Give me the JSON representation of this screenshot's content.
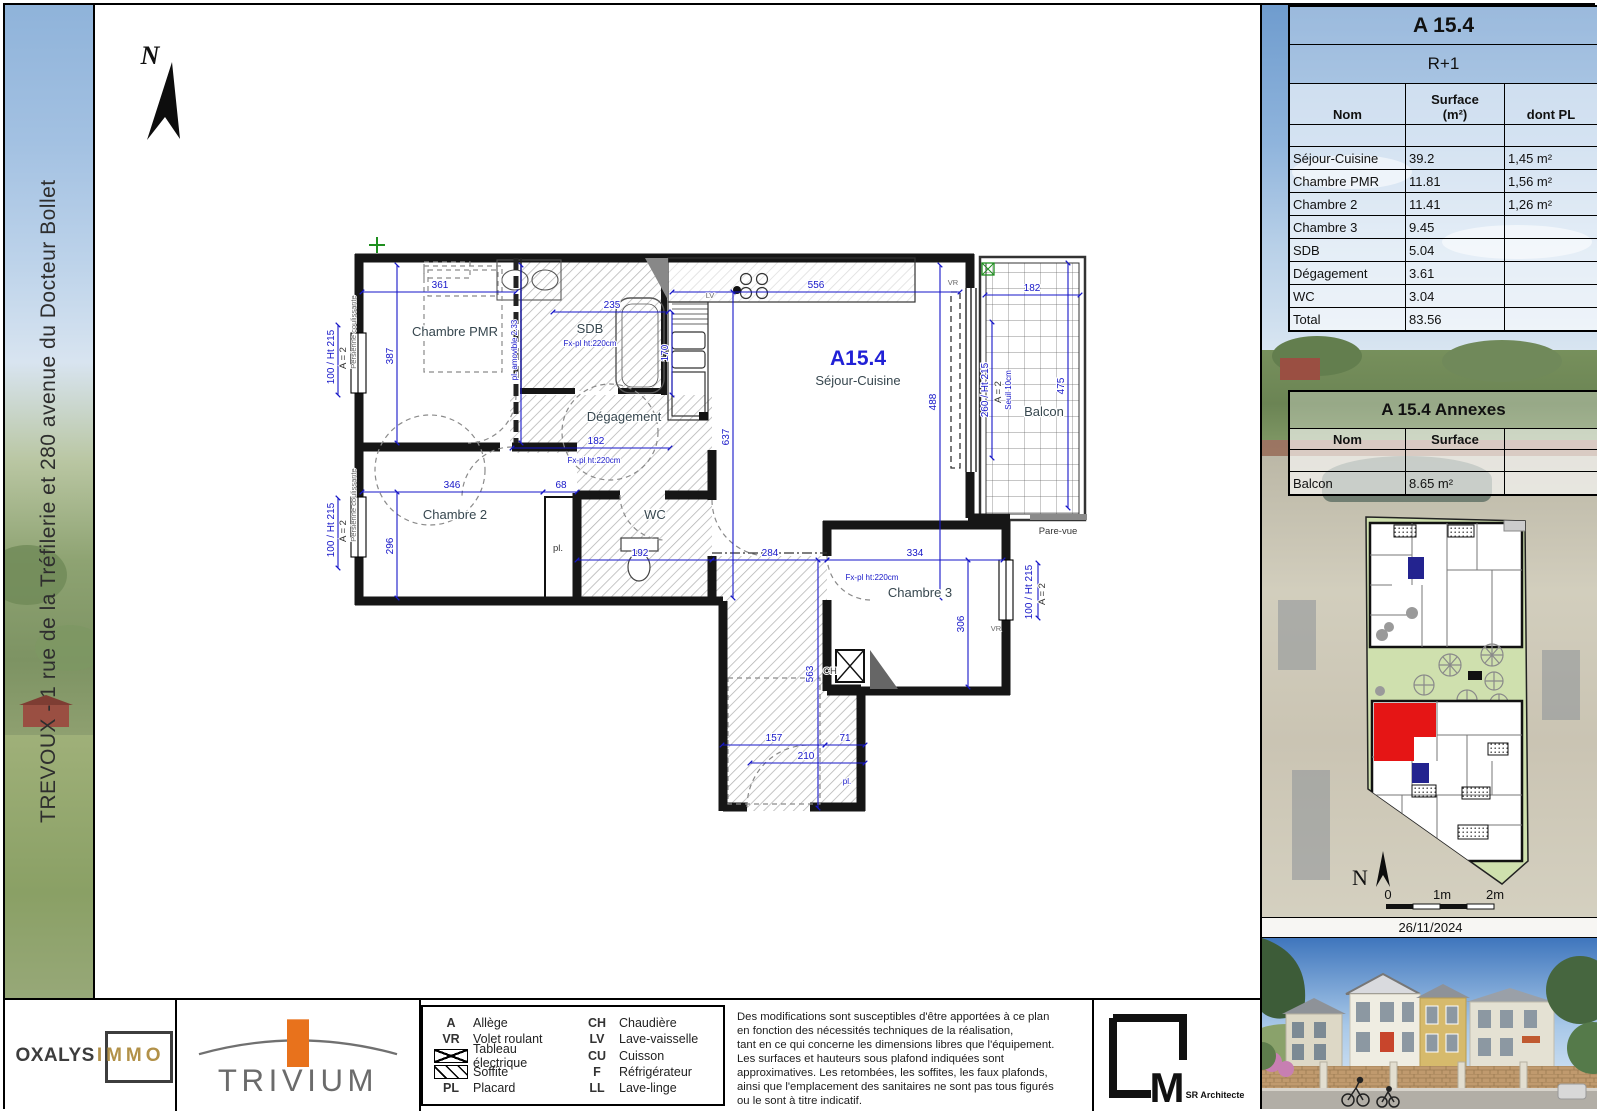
{
  "sidebar": {
    "title": "TREVOUX - 1 rue de la Tréfilerie et 280 avenue du Docteur Bollet"
  },
  "unit_table": {
    "title": "A 15.4",
    "floor": "R+1",
    "col_nom": "Nom",
    "col_surface": "Surface",
    "col_surface_unit": "(m²)",
    "col_pl": "dont PL",
    "rows": [
      {
        "nom": "Séjour-Cuisine",
        "surface": "39.2",
        "pl": "1,45 m²"
      },
      {
        "nom": "Chambre PMR",
        "surface": "11.81",
        "pl": "1,56 m²"
      },
      {
        "nom": "Chambre 2",
        "surface": "11.41",
        "pl": "1,26 m²"
      },
      {
        "nom": "Chambre 3",
        "surface": "9.45",
        "pl": ""
      },
      {
        "nom": "SDB",
        "surface": "5.04",
        "pl": ""
      },
      {
        "nom": "Dégagement",
        "surface": "3.61",
        "pl": ""
      },
      {
        "nom": "WC",
        "surface": "3.04",
        "pl": ""
      },
      {
        "nom": "Total",
        "surface": "83.56",
        "pl": ""
      }
    ]
  },
  "annex_table": {
    "title": "A 15.4 Annexes",
    "col_nom": "Nom",
    "col_surface": "Surface",
    "rows": [
      {
        "nom": "Balcon",
        "surface": "8.65 m²"
      }
    ]
  },
  "key_plan": {
    "north": "N",
    "scale": [
      "0",
      "1m",
      "2m"
    ],
    "date": "26/11/2024",
    "highlight_color": "#e51515",
    "secondary_color": "#23238f"
  },
  "legend": {
    "left": [
      {
        "code": "A",
        "label": "Allège"
      },
      {
        "code": "VR",
        "label": "Volet roulant"
      },
      {
        "code": "",
        "icon": "elec",
        "label": "Tableau électrique"
      },
      {
        "code": "",
        "icon": "soffit",
        "label": "Soffite"
      },
      {
        "code": "PL",
        "label": "Placard"
      }
    ],
    "right": [
      {
        "code": "CH",
        "label": "Chaudière"
      },
      {
        "code": "LV",
        "label": "Lave-vaisselle"
      },
      {
        "code": "CU",
        "label": "Cuisson"
      },
      {
        "code": "F",
        "label": "Réfrigérateur"
      },
      {
        "code": "LL",
        "label": "Lave-linge"
      }
    ]
  },
  "disclaimer": "Des modifications sont susceptibles d'être apportées à ce plan\nen fonction des nécessités techniques de la réalisation,\ntant en ce qui concerne les dimensions libres que l'équipement.\nLes surfaces et hauteurs sous plafond indiquées sont\napproximatives. Les retombées, les soffites, les faux plafonds,\nainsi que l'emplacement des sanitaires ne sont pas tous figurés\nou le sont à titre indicatif.",
  "logos": {
    "oxalys_part1": "OXALYS",
    "oxalys_part2": "IMMO",
    "trivium": "TRIVIUM",
    "architect_m": "M",
    "architect_sub": "SR Architecte"
  },
  "plan_labels": [
    {
      "x": 455,
      "y": 336,
      "t": "Chambre PMR",
      "c": "room"
    },
    {
      "x": 590,
      "y": 333,
      "t": "SDB",
      "c": "room"
    },
    {
      "x": 590,
      "y": 346,
      "t": "Fx-pl ht:220cm",
      "c": "tb"
    },
    {
      "x": 624,
      "y": 421,
      "t": "Dégagement",
      "c": "room"
    },
    {
      "x": 455,
      "y": 519,
      "t": "Chambre 2",
      "c": "room"
    },
    {
      "x": 655,
      "y": 519,
      "t": "WC",
      "c": "room"
    },
    {
      "x": 858,
      "y": 365,
      "t": "A15.4",
      "c": "big"
    },
    {
      "x": 858,
      "y": 385,
      "t": "Séjour-Cuisine",
      "c": "room"
    },
    {
      "x": 920,
      "y": 597,
      "t": "Chambre 3",
      "c": "room"
    },
    {
      "x": 1044,
      "y": 416,
      "t": "Balcon",
      "c": "room"
    },
    {
      "x": 1058,
      "y": 534,
      "t": "Pare-vue",
      "c": "sm"
    },
    {
      "x": 558,
      "y": 551,
      "t": "pl.",
      "c": "sm"
    },
    {
      "x": 847,
      "y": 784,
      "t": "pl.",
      "c": "tb"
    },
    {
      "x": 830,
      "y": 674,
      "t": "CH",
      "c": "sm"
    },
    {
      "x": 710,
      "y": 298,
      "t": "LV",
      "c": "xs"
    },
    {
      "x": 953,
      "y": 285,
      "t": "VR",
      "c": "xs"
    },
    {
      "x": 996,
      "y": 631,
      "t": "VR",
      "c": "xs"
    },
    {
      "x": 440,
      "y": 288,
      "t": "361",
      "c": "dim"
    },
    {
      "x": 612,
      "y": 308,
      "t": "235",
      "c": "dim"
    },
    {
      "x": 816,
      "y": 288,
      "t": "556",
      "c": "dim"
    },
    {
      "x": 1032,
      "y": 291,
      "t": "182",
      "c": "dim"
    },
    {
      "x": 596,
      "y": 444,
      "t": "182",
      "c": "dim"
    },
    {
      "x": 594,
      "y": 463,
      "t": "Fx-pl ht:220cm",
      "c": "tb"
    },
    {
      "x": 452,
      "y": 488,
      "t": "346",
      "c": "dim"
    },
    {
      "x": 561,
      "y": 488,
      "t": "68",
      "c": "dim"
    },
    {
      "x": 640,
      "y": 556,
      "t": "192",
      "c": "dim"
    },
    {
      "x": 770,
      "y": 556,
      "t": "284",
      "c": "dim"
    },
    {
      "x": 872,
      "y": 580,
      "t": "Fx-pl ht:220cm",
      "c": "tb"
    },
    {
      "x": 915,
      "y": 556,
      "t": "334",
      "c": "dim"
    },
    {
      "x": 774,
      "y": 741,
      "t": "157",
      "c": "dim"
    },
    {
      "x": 845,
      "y": 741,
      "t": "71",
      "c": "dim"
    },
    {
      "x": 806,
      "y": 759,
      "t": "210",
      "c": "dim"
    },
    {
      "x": 393,
      "y": 356,
      "t": "387",
      "c": "dim",
      "r": 1
    },
    {
      "x": 517,
      "y": 350,
      "t": "pl. amovible 2.33",
      "c": "tb",
      "r": 1
    },
    {
      "x": 668,
      "y": 353,
      "t": "170",
      "c": "dim",
      "r": 1
    },
    {
      "x": 729,
      "y": 437,
      "t": "637",
      "c": "dim",
      "r": 1
    },
    {
      "x": 936,
      "y": 402,
      "t": "488",
      "c": "dim",
      "r": 1
    },
    {
      "x": 1064,
      "y": 386,
      "t": "475",
      "c": "dim",
      "r": 1
    },
    {
      "x": 988,
      "y": 390,
      "t": "260 / Ht 215",
      "c": "dim",
      "r": 1
    },
    {
      "x": 1001,
      "y": 392,
      "t": "A = 2",
      "c": "sm",
      "r": 1
    },
    {
      "x": 1011,
      "y": 390,
      "t": "Seuil 10cm",
      "c": "tb",
      "r": 1
    },
    {
      "x": 393,
      "y": 546,
      "t": "296",
      "c": "dim",
      "r": 1
    },
    {
      "x": 964,
      "y": 624,
      "t": "306",
      "c": "dim",
      "r": 1
    },
    {
      "x": 813,
      "y": 674,
      "t": "563",
      "c": "dim",
      "r": 1
    },
    {
      "x": 334,
      "y": 357,
      "t": "100 / Ht 215",
      "c": "dim",
      "r": 1
    },
    {
      "x": 346,
      "y": 358,
      "t": "A = 2",
      "c": "sm",
      "r": 1
    },
    {
      "x": 356,
      "y": 332,
      "t": "Persienne coulissante",
      "c": "xs",
      "r": 1
    },
    {
      "x": 334,
      "y": 530,
      "t": "100 / Ht 215",
      "c": "dim",
      "r": 1
    },
    {
      "x": 346,
      "y": 531,
      "t": "A = 2",
      "c": "sm",
      "r": 1
    },
    {
      "x": 356,
      "y": 505,
      "t": "Persienne coulissante",
      "c": "xs",
      "r": 1
    },
    {
      "x": 1032,
      "y": 592,
      "t": "100 / Ht 215",
      "c": "dim",
      "r": 1
    },
    {
      "x": 1045,
      "y": 594,
      "t": "A = 2",
      "c": "sm",
      "r": 1
    },
    {
      "x": 150,
      "y": 64,
      "t": "N",
      "c": "north"
    }
  ]
}
